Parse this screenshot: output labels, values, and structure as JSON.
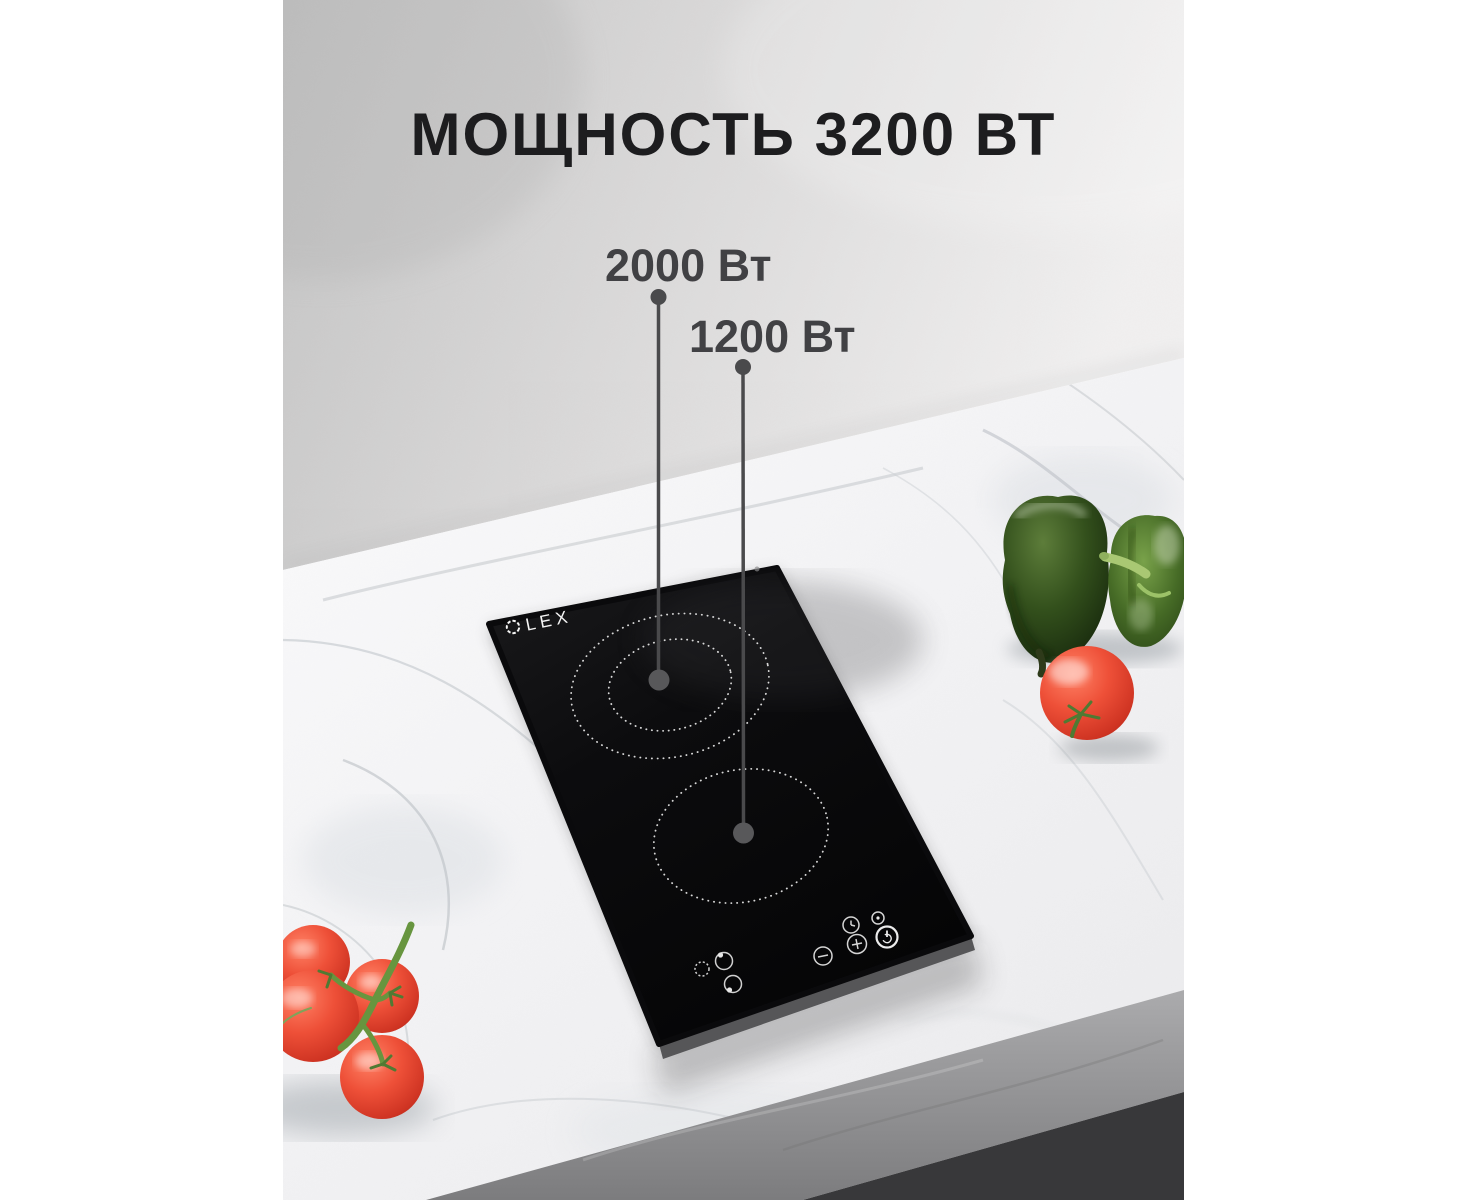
{
  "title": "МОЩНОСТЬ 3200 ВТ",
  "callouts": [
    {
      "label": "2000 Вт",
      "target": "upper-burner"
    },
    {
      "label": "1200 Вт",
      "target": "lower-burner"
    }
  ],
  "cooktop": {
    "brand": "LEX",
    "type": "ceramic-hob-2-burner",
    "burners": [
      {
        "position": "upper",
        "power": "2000 Вт",
        "rings": 2
      },
      {
        "position": "lower",
        "power": "1200 Вт",
        "rings": 1
      }
    ],
    "control_icons": [
      "dual-zone-indicator-icon",
      "rear-zone-select-icon",
      "front-zone-select-icon",
      "minus-icon",
      "plus-icon",
      "timer-icon",
      "lock-icon",
      "power-icon"
    ]
  },
  "scene": {
    "objects": [
      "green-bell-peppers",
      "tomato",
      "tomato-vine-cluster",
      "marble-countertop",
      "plaster-wall"
    ],
    "colors": {
      "title_text": "#1d1d1f",
      "callout_text": "#414144",
      "callout_line": "#4a4a4c",
      "glass_black": "#0a0a0c",
      "marble_white": "#f4f4f5",
      "wall_left": "#c6c6c6",
      "wall_right": "#efeeee",
      "counter_edge": "#96969a",
      "under_counter": "#38383a",
      "tomato_red": "#e2452f",
      "pepper_dark_green": "#2c4517",
      "pepper_light_green": "#4a702a",
      "vine_green": "#67953f",
      "burner_ring": "#e9e9e9",
      "logo_white": "#f5f5f5"
    }
  }
}
